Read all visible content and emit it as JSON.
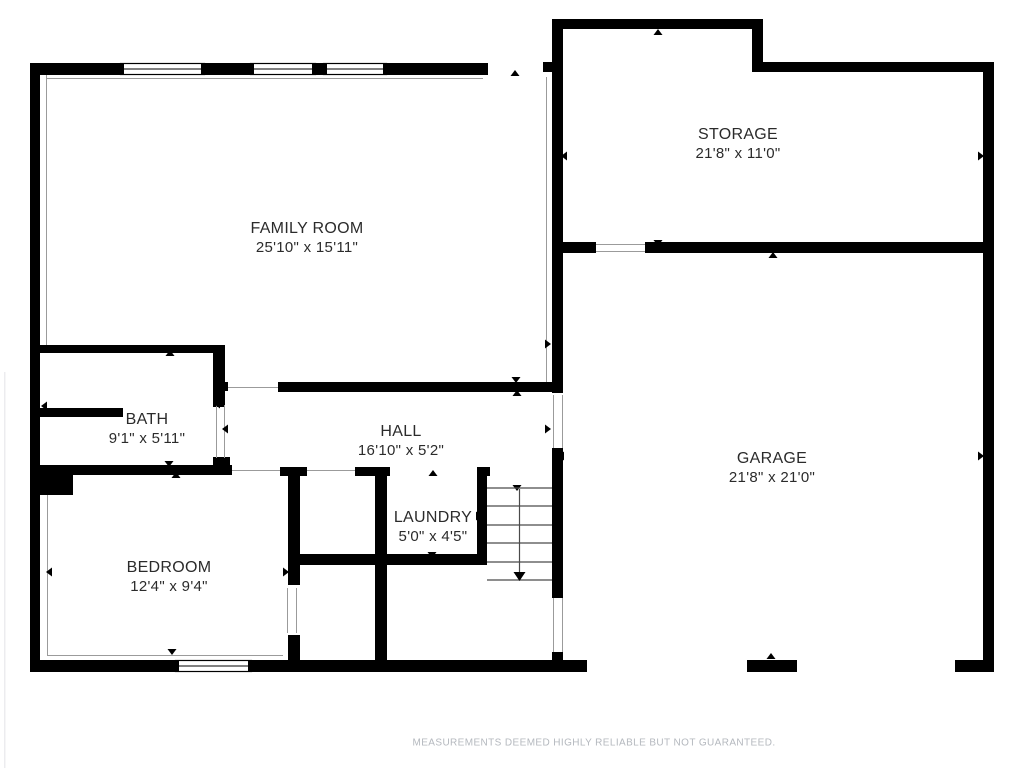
{
  "colors": {
    "background": "#ffffff",
    "wall": "#000000",
    "thin_line": "#9b9b9b",
    "stair_line": "#4a4a4a",
    "text": "#2b2b2b",
    "disclaimer": "#b4b8be",
    "photo_edge": "#ececef"
  },
  "disclaimer": "MEASUREMENTS DEEMED HIGHLY RELIABLE BUT NOT GUARANTEED.",
  "rooms": [
    {
      "name": "FAMILY ROOM",
      "dims": "25'10\" x 15'11\"",
      "cx": 307,
      "cy": 238
    },
    {
      "name": "STORAGE",
      "dims": "21'8\" x 11'0\"",
      "cx": 738,
      "cy": 144
    },
    {
      "name": "BATH",
      "dims": "9'1\" x 5'11\"",
      "cx": 147,
      "cy": 429
    },
    {
      "name": "HALL",
      "dims": "16'10\" x 5'2\"",
      "cx": 401,
      "cy": 441
    },
    {
      "name": "LAUNDRY",
      "dims": "5'0\" x 4'5\"",
      "cx": 433,
      "cy": 527
    },
    {
      "name": "BEDROOM",
      "dims": "12'4\" x 9'4\"",
      "cx": 169,
      "cy": 577
    },
    {
      "name": "GARAGE",
      "dims": "21'8\" x 21'0\"",
      "cx": 772,
      "cy": 468
    }
  ],
  "floorplan": {
    "walls": [
      [
        30,
        63,
        10,
        609
      ],
      [
        30,
        63,
        90,
        12
      ],
      [
        205,
        63,
        45,
        12
      ],
      [
        316,
        63,
        7,
        12
      ],
      [
        387,
        63,
        101,
        12
      ],
      [
        543,
        62,
        10,
        10
      ],
      [
        552,
        19,
        11,
        374
      ],
      [
        552,
        19,
        211,
        10
      ],
      [
        752,
        19,
        11,
        53
      ],
      [
        752,
        62,
        242,
        10
      ],
      [
        983,
        62,
        11,
        610
      ],
      [
        563,
        242,
        33,
        11
      ],
      [
        645,
        242,
        338,
        11
      ],
      [
        30,
        345,
        195,
        8
      ],
      [
        213,
        345,
        12,
        62
      ],
      [
        218,
        382,
        10,
        9
      ],
      [
        213,
        457,
        17,
        18
      ],
      [
        40,
        408,
        83,
        9
      ],
      [
        30,
        465,
        202,
        10
      ],
      [
        30,
        465,
        43,
        30
      ],
      [
        278,
        382,
        285,
        10
      ],
      [
        280,
        467,
        27,
        9
      ],
      [
        288,
        476,
        12,
        109
      ],
      [
        288,
        635,
        12,
        37
      ],
      [
        288,
        554,
        199,
        11
      ],
      [
        355,
        467,
        35,
        9
      ],
      [
        375,
        467,
        12,
        205
      ],
      [
        477,
        467,
        13,
        9
      ],
      [
        477,
        476,
        10,
        89
      ],
      [
        552,
        448,
        11,
        150
      ],
      [
        552,
        652,
        11,
        20
      ],
      [
        30,
        660,
        145,
        12
      ],
      [
        252,
        660,
        335,
        12
      ],
      [
        747,
        660,
        50,
        12
      ],
      [
        955,
        660,
        39,
        12
      ]
    ],
    "windows": [
      [
        120,
        63,
        85,
        12
      ],
      [
        250,
        63,
        66,
        12
      ],
      [
        323,
        63,
        64,
        12
      ],
      [
        175,
        660,
        77,
        12
      ]
    ],
    "thin_lines": [
      [
        46.5,
        75,
        46.5,
        345
      ],
      [
        46,
        78.5,
        483,
        78.5
      ],
      [
        546.5,
        77,
        546.5,
        382
      ],
      [
        47.5,
        495,
        47.5,
        655
      ],
      [
        47,
        655.5,
        283,
        655.5
      ],
      [
        232,
        470.5,
        280,
        470.5
      ],
      [
        307,
        470.5,
        355,
        470.5
      ],
      [
        228,
        387.5,
        278,
        387.5
      ],
      [
        216.5,
        405,
        216.5,
        458
      ],
      [
        224.5,
        405,
        224.5,
        458
      ],
      [
        287.5,
        588,
        287.5,
        633
      ],
      [
        296.5,
        588,
        296.5,
        633
      ],
      [
        553.5,
        395,
        553.5,
        448
      ],
      [
        562.5,
        395,
        562.5,
        448
      ],
      [
        553.5,
        598,
        553.5,
        652
      ],
      [
        562.5,
        598,
        562.5,
        652
      ],
      [
        596,
        244.5,
        645,
        244.5
      ],
      [
        596,
        251.5,
        645,
        251.5
      ]
    ],
    "markers": [
      {
        "dir": "up",
        "x": 515,
        "y": 70
      },
      {
        "dir": "up",
        "x": 658,
        "y": 29
      },
      {
        "dir": "left",
        "x": 561,
        "y": 156
      },
      {
        "dir": "right",
        "x": 984,
        "y": 156
      },
      {
        "dir": "down",
        "x": 658,
        "y": 246
      },
      {
        "dir": "up",
        "x": 773,
        "y": 252
      },
      {
        "dir": "right",
        "x": 551,
        "y": 344
      },
      {
        "dir": "up",
        "x": 170,
        "y": 350
      },
      {
        "dir": "left",
        "x": 41,
        "y": 406
      },
      {
        "dir": "down",
        "x": 169,
        "y": 467
      },
      {
        "dir": "up",
        "x": 176,
        "y": 472
      },
      {
        "dir": "left",
        "x": 214,
        "y": 404
      },
      {
        "dir": "left",
        "x": 222,
        "y": 429
      },
      {
        "dir": "down",
        "x": 516,
        "y": 383
      },
      {
        "dir": "up",
        "x": 517,
        "y": 390
      },
      {
        "dir": "right",
        "x": 551,
        "y": 429
      },
      {
        "dir": "left",
        "x": 558,
        "y": 456
      },
      {
        "dir": "up",
        "x": 433,
        "y": 470
      },
      {
        "dir": "left",
        "x": 380,
        "y": 513
      },
      {
        "dir": "right",
        "x": 482,
        "y": 516
      },
      {
        "dir": "down",
        "x": 432,
        "y": 558
      },
      {
        "dir": "down",
        "x": 517,
        "y": 491
      },
      {
        "dir": "left",
        "x": 46,
        "y": 572
      },
      {
        "dir": "right",
        "x": 289,
        "y": 572
      },
      {
        "dir": "down",
        "x": 172,
        "y": 655
      },
      {
        "dir": "up",
        "x": 771,
        "y": 653
      },
      {
        "dir": "right",
        "x": 984,
        "y": 456
      }
    ],
    "stairs": {
      "x1": 487,
      "x2": 552,
      "treads_y": [
        488,
        506,
        525,
        543,
        562,
        580
      ],
      "arrow_x": 519.5,
      "arrow_y1": 489,
      "arrow_y2": 572,
      "arrow_tip_y": 581
    },
    "photo_edge": [
      4,
      372,
      1.5,
      396
    ]
  }
}
